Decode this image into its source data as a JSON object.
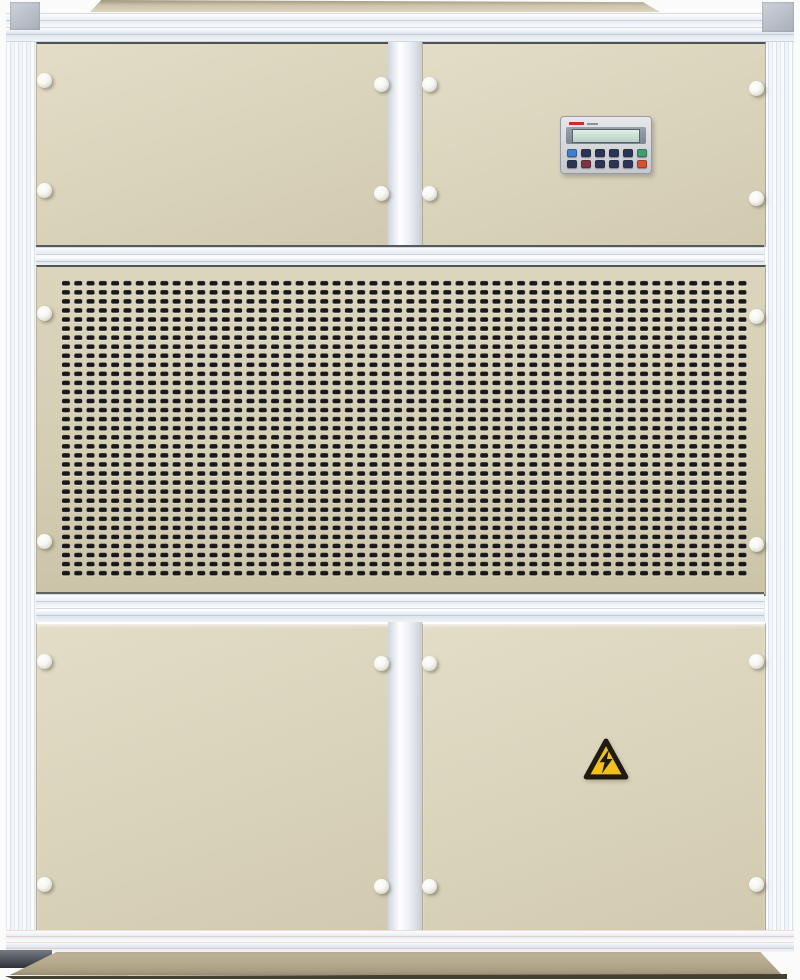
{
  "scene": {
    "type": "photograph",
    "subject": "Industrial air-handling / dehumidifier cabinet, front view",
    "background": "#fbfbfc"
  },
  "colors": {
    "panel_cream": "#dcd6bf",
    "panel_cream_dark": "#cdc6aa",
    "frame_silver": "#eef2f7",
    "frame_line": "#c3cad4",
    "corner_grey": "#b7bcc6",
    "slot_black": "#17171c",
    "roof_tan": "#cfc8ad",
    "base_tan": "#b5aa8e",
    "base_shadow": "#453f30",
    "lcd_green": "#c9ddd2",
    "panel_grey": "#d6d7da",
    "screen_band": "#8b94a1",
    "btn_dark": "#2b3452",
    "btn_blue": "#3f7fd2",
    "btn_green": "#3fa06d",
    "btn_red": "#d8502f",
    "btn_maroon": "#7c3440",
    "warning_yellow": "#f2c01d",
    "warning_black": "#1f1b12",
    "knob_white": "#f6f6f2"
  },
  "control_panel": {
    "display_text": "",
    "button_rows": [
      [
        "btn_blue",
        "btn_dark",
        "btn_dark",
        "btn_dark",
        "btn_dark",
        "btn_green"
      ],
      [
        "btn_dark",
        "btn_maroon",
        "btn_dark",
        "btn_dark",
        "btn_dark",
        "btn_red"
      ]
    ]
  },
  "grille": {
    "slot_columns": 56,
    "slot_rows": 33,
    "slot_shape": "rounded-rect"
  },
  "stickers": {
    "high_voltage": {
      "symbol": "lightning-bolt-in-triangle"
    }
  },
  "fasteners": {
    "knob_count": 20
  }
}
